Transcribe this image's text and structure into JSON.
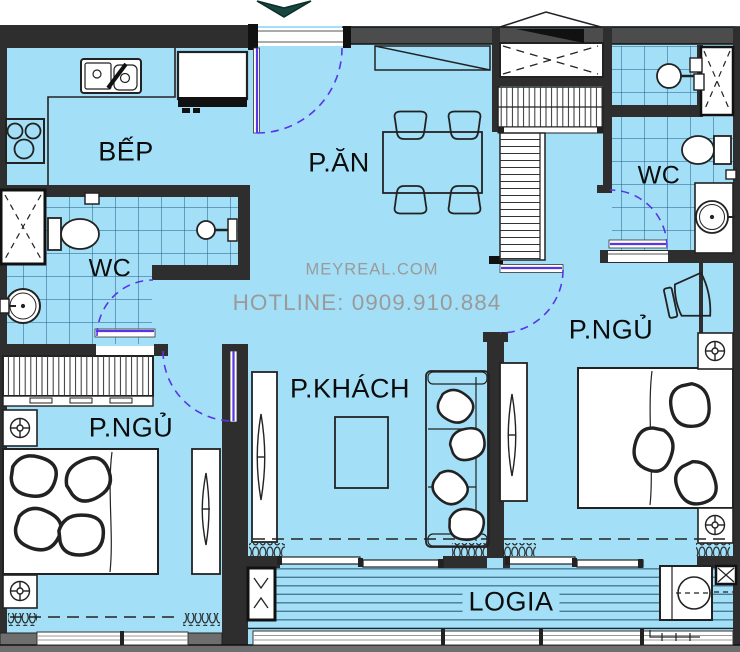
{
  "title": "Apartment floor plan",
  "colors": {
    "floor": "#a3e0f7",
    "wall": "#2e2e2e",
    "wall-light": "#4c4c4c",
    "sill": "#6e6e6e",
    "line": "#1a1a1a",
    "tile": "#1d5a85",
    "deck": "#4a7a96",
    "door": "#5a35e8",
    "arrow": "#17473f",
    "label": "#0c0c0c",
    "watermark": "#9a9a9a"
  },
  "labels": {
    "kitchen": "BẾP",
    "dining": "P.ĂN",
    "wc_left": "WC",
    "wc_right": "WC",
    "bedroom_left": "P.NGỦ",
    "bedroom_right": "P.NGỦ",
    "living": "P.KHÁCH",
    "loggia": "LOGIA"
  },
  "watermark": {
    "site": "MEYREAL.COM",
    "hotline": "HOTLINE: 0909.910.884"
  },
  "icons": {
    "entrance_marker": "down-arrow"
  }
}
